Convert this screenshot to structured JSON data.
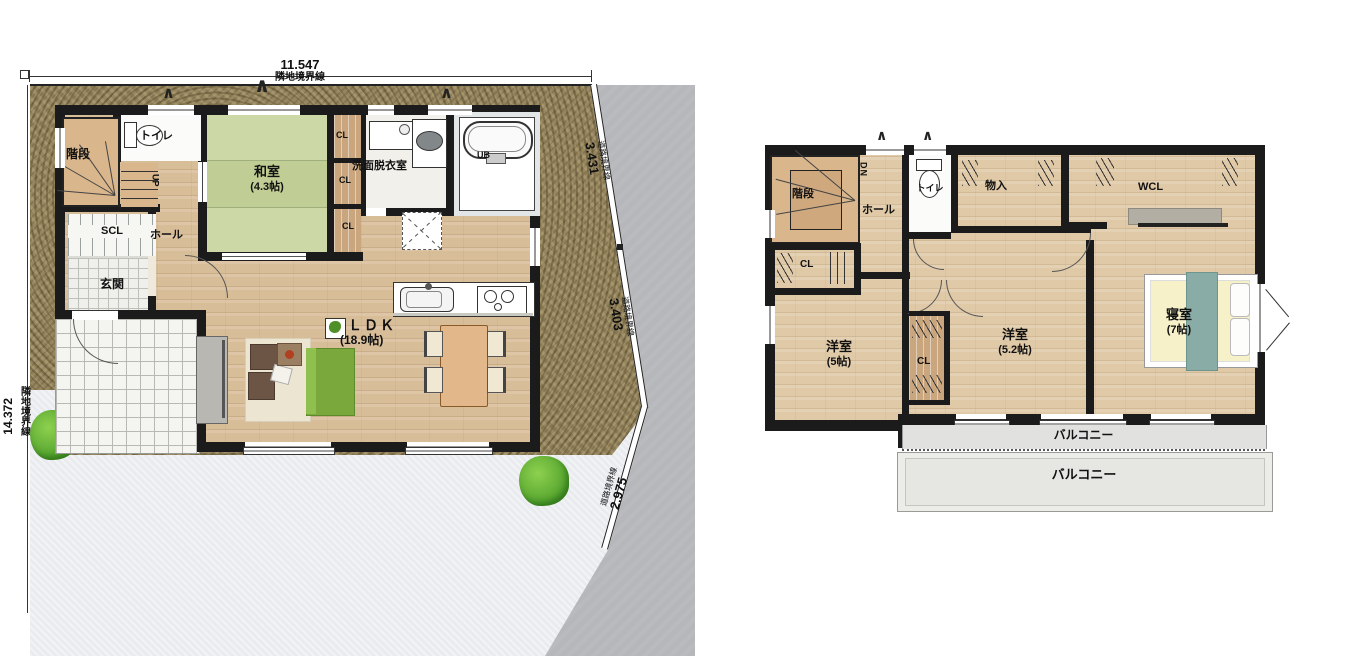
{
  "floor1": {
    "dim_top_value": "11.547",
    "dim_top_label": "隣地境界線",
    "dim_left_value": "14.372",
    "dim_left_label": "隣地境界線",
    "dim_road1_value": "3.431",
    "dim_road1_label": "道路境界線",
    "dim_road2_value": "3.403",
    "dim_road2_label": "道路境界線",
    "dim_road3_value": "2.975",
    "dim_road3_label": "道路境界線",
    "stairs": "階段",
    "up": "UP",
    "toilet": "トイレ",
    "tatami_room": "和室",
    "tatami_size": "(4.3帖)",
    "cl_top": "CL",
    "cl_mid": "CL",
    "cl_bottom": "CL",
    "washroom": "洗面脱衣室",
    "bath": "UB",
    "scl": "SCL",
    "entry": "玄関",
    "hall": "ホール",
    "ldk": "ＬＤＫ",
    "ldk_size": "(18.9帖)"
  },
  "floor2": {
    "stairs": "階段",
    "dn": "DN",
    "hall": "ホール",
    "toilet": "トイレ",
    "storage": "物入",
    "wcl": "WCL",
    "cl_a": "CL",
    "cl_b": "CL",
    "room1": "洋室",
    "room1_size": "(5帖)",
    "room2": "洋室",
    "room2_size": "(5.2帖)",
    "bedroom": "寝室",
    "bedroom_size": "(7帖)",
    "balcony_inner": "バルコニー",
    "balcony_outer": "バルコニー"
  },
  "icons": {
    "awning": "∧"
  },
  "colors": {
    "wall": "#1b1b1b",
    "tatami": "#c9d5a2",
    "wood": "#d8bd99",
    "lot": "#97875f",
    "road": "#b5b7ba",
    "yard": "#e9ebef",
    "balcony": "#e1e1df"
  }
}
